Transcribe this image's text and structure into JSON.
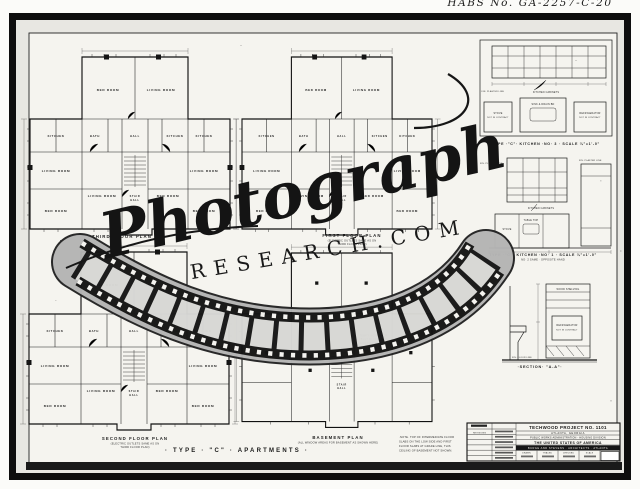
{
  "photo": {
    "handwritten_id": "HABS No. GA-2257-C-20"
  },
  "watermark": {
    "script": "Photograph",
    "caps": "RESEARCH.COM"
  },
  "sheet": {
    "title": "· TYPE · \"C\" · APARTMENTS ·",
    "plans": {
      "third": {
        "caption": "THIRD   FLOOR   PLAN"
      },
      "first": {
        "caption": "FIRST   FLOOR   PLAN",
        "sub1": "(ELECTRIC OUTLETS SAME AS ON",
        "sub2": "THIRD FLOOR PLAN)"
      },
      "second": {
        "caption": "SECOND   FLOOR   PLAN",
        "sub1": "(ELECTRIC OUTLETS SAME AS ON",
        "sub2": "THIRD FLOOR PLAN)"
      },
      "basement": {
        "caption": "BASEMENT   PLAN",
        "sub": "(ALL WINDOW AREAS FOR BASEMENT AS SHOWN HERE)"
      }
    },
    "rooms": {
      "bed": "BED ROOM",
      "living": "LIVING ROOM",
      "bath": "BATH",
      "hall": "HALL",
      "kitchen": "KITCHEN",
      "stair1": "STAIR",
      "stair2": "HALL"
    },
    "basement": {
      "inc1": "TEMP'Y INCINERATOR",
      "inc2": "(BUILT IN) USED WITH",
      "inc3": "SPECIFICATIONS"
    },
    "note": {
      "n1": "·NOTE·  TOP OF INTERMEDIATE FLOOR",
      "n2": "SLABS ON THE LOW SIDE AND FIRST",
      "n3": "FLOOR SLABS AT GRADE LINE, THIS",
      "n4": "CEILING OF BASEMENT NOT SHOWN."
    },
    "details": {
      "kitchen3": {
        "caption": "TYPE ·\"C\"· KITCHEN ·NO· 3 · SCALE ¼\"=1'-0\"",
        "cab": "KITCHEN CABINETS",
        "stove": "STOVE",
        "nc": "NOT IN CONTRACT",
        "sink": "SINK & DRAIN BD",
        "refr": "REFRIGERATOR",
        "plaster": "FIN. PLASTER LINE"
      },
      "kitchen1": {
        "caption": "TYPE ·\"C\"· KITCHEN ·NO· 1 · SCALE ¼\"=1'-0\"",
        "caption2": "NO· 2 SAME · OPPOSITE HAND",
        "table": "TABLE TOP",
        "stove": "STOVE",
        "cab": "KITCHEN CABINETS",
        "plaster": "FIN. PLASTER LINE"
      },
      "section": {
        "caption": "·SECTION· \"A-A\"·",
        "shelving": "WOOD SHELVING",
        "refr": "REFRIGERATOR",
        "nc": "NOT IN CONTRACT",
        "floor": "FIN. FLOOR LINE"
      }
    },
    "titleblock": {
      "project": "TECHWOOD  PROJECT  NO.  1101",
      "city": "ATLANTA,  GEORGIA",
      "admin": "PUBLIC WORKS ADMINISTRATION - HOUSING DIVISION",
      "usa": "THE  UNITED  STATES  OF  AMERICA",
      "architects": "BURGE  AND  STEVENS  ·  ARCHITECTS  ·  ATLANTA",
      "revisions": "REVISIONS",
      "cells": [
        "DRAWN",
        "TRACED",
        "CHECKED",
        "SCALE",
        "DATE"
      ]
    }
  }
}
